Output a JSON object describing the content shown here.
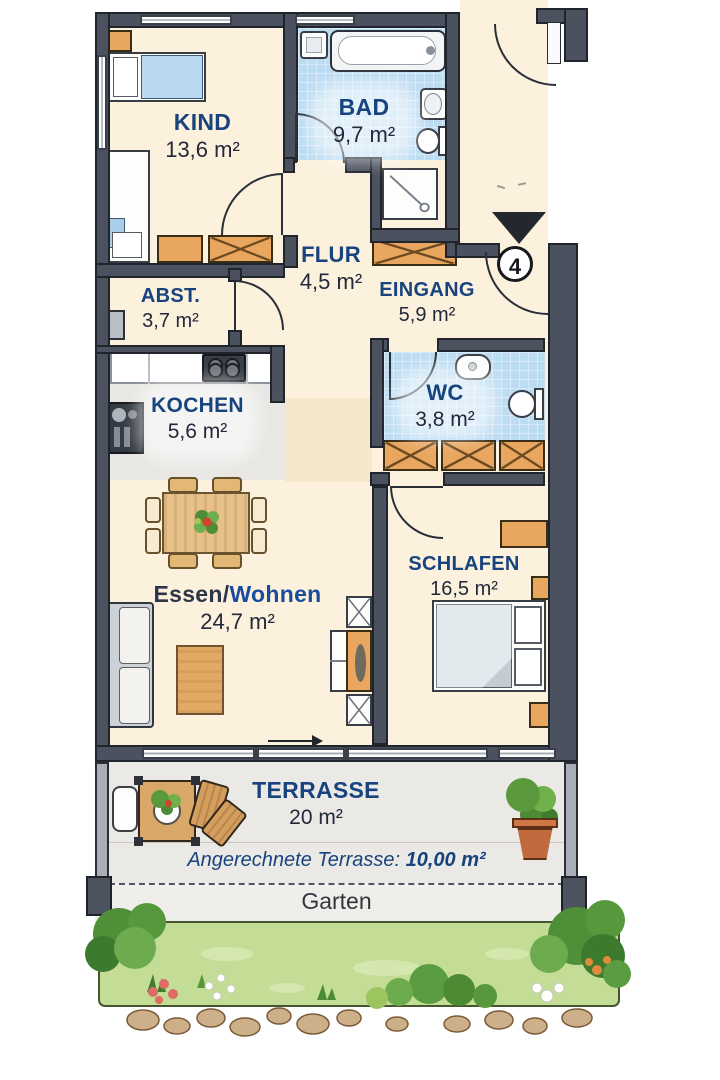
{
  "unit_badge": {
    "number": "4"
  },
  "rooms": {
    "kind": {
      "name": "KIND",
      "area": "13,6 m²"
    },
    "bad": {
      "name": "BAD",
      "area": "9,7 m²"
    },
    "flur": {
      "name": "FLUR",
      "area": "4,5 m²"
    },
    "eingang": {
      "name": "EINGANG",
      "area": "5,9 m²"
    },
    "abst": {
      "name": "ABST.",
      "area": "3,7 m²"
    },
    "kochen": {
      "name": "KOCHEN",
      "area": "5,6 m²"
    },
    "wc": {
      "name": "WC",
      "area": "3,8 m²"
    },
    "wohnen": {
      "name_prefix": "Essen/",
      "name_suffix": "Wohnen",
      "area": "24,7 m²"
    },
    "schlafen": {
      "name": "SCHLAFEN",
      "area": "16,5 m²"
    }
  },
  "terrace": {
    "name": "TERRASSE",
    "area": "20 m²",
    "note_label": "Angerechnete Terrasse:",
    "note_value": "10,00 m²"
  },
  "garden": {
    "label": "Garten"
  },
  "colors": {
    "label_blue": "#17437f",
    "area_text": "#23283a",
    "wall_gray": "#4b515e",
    "room_floor": "#fbf1dd",
    "tile_blue": "#bcdcf2",
    "furniture_orange": "#e9a65f",
    "terrace_bg": "#ebe9e5",
    "grass_green": "#c3dd97"
  }
}
